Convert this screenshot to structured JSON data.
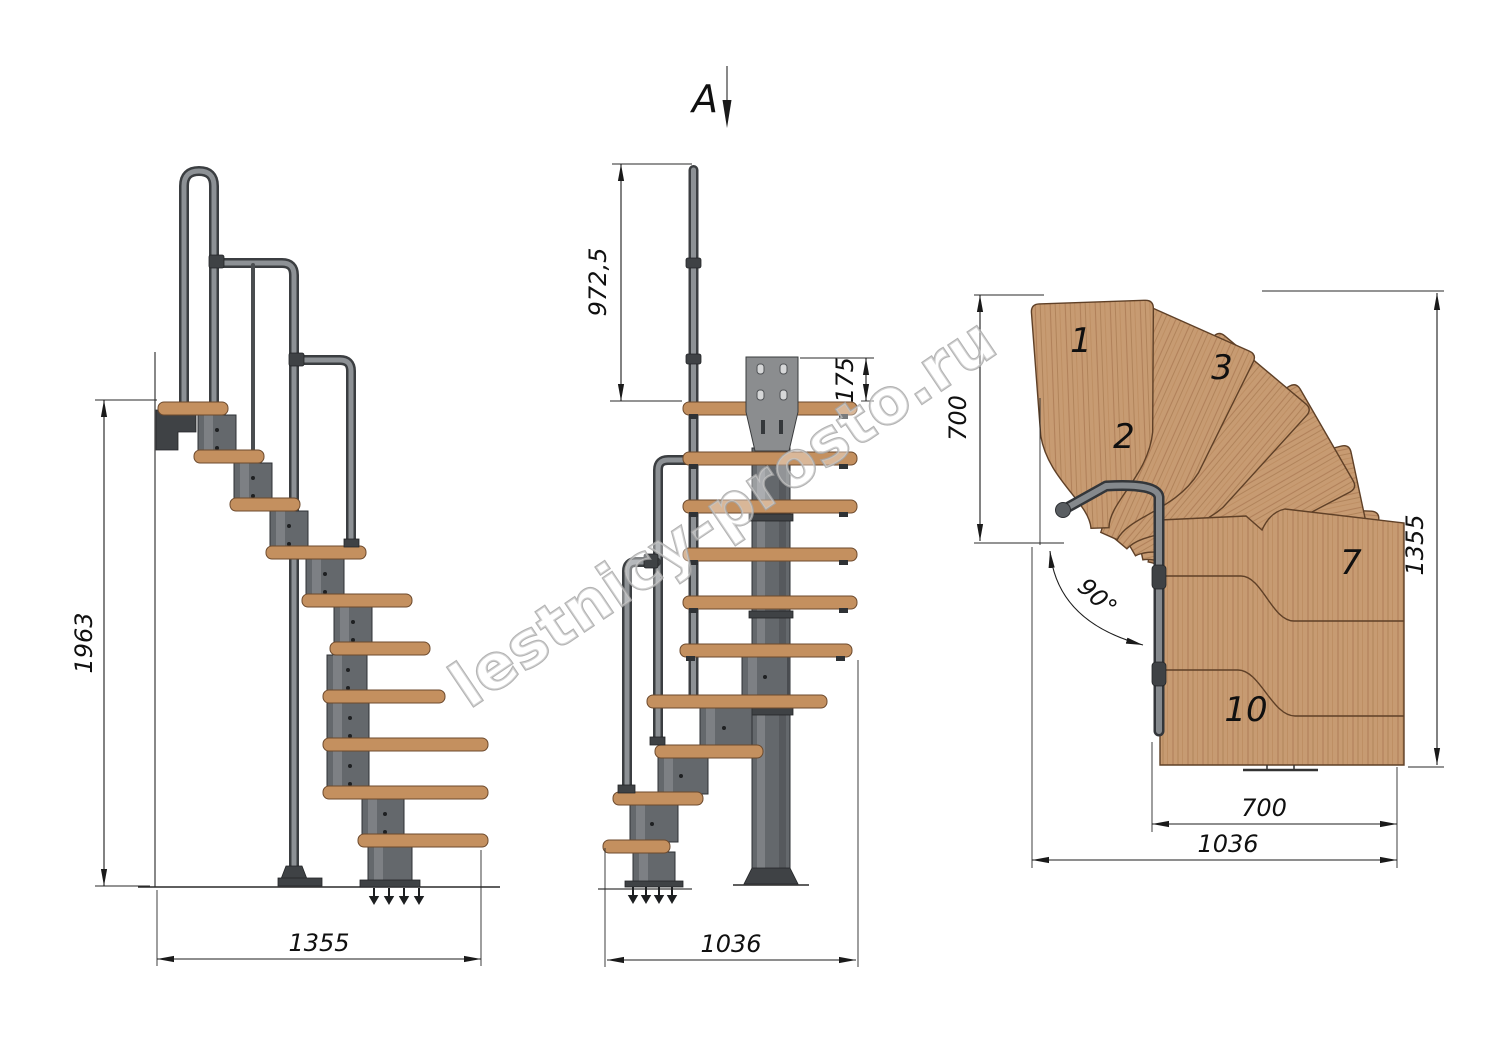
{
  "drawing": {
    "watermark_text": "lestnicy-prosto.ru",
    "section_marker": "A"
  },
  "side_view": {
    "height_dim": "1963",
    "width_dim": "1355"
  },
  "front_view": {
    "handrail_height_dim": "972,5",
    "bracket_height_dim": "175",
    "width_dim": "1036"
  },
  "plan_view": {
    "inner_depth_dim": "700",
    "outer_depth_dim": "1355",
    "flight_width_dim": "700",
    "total_width_dim": "1036",
    "turn_angle_label": "90°",
    "tread_labels": [
      "1",
      "2",
      "3",
      "7",
      "10"
    ]
  },
  "colors": {
    "wood_side": "#c4905f",
    "wood_plan": "#c79b72",
    "wood_grain": "#a3744c",
    "wood_edge": "#5f4027",
    "metal": "#64686c",
    "metal_dark": "#3f4245",
    "line": "#1c1c1c",
    "watermark": "#a6a6a6",
    "background": "#ffffff"
  }
}
